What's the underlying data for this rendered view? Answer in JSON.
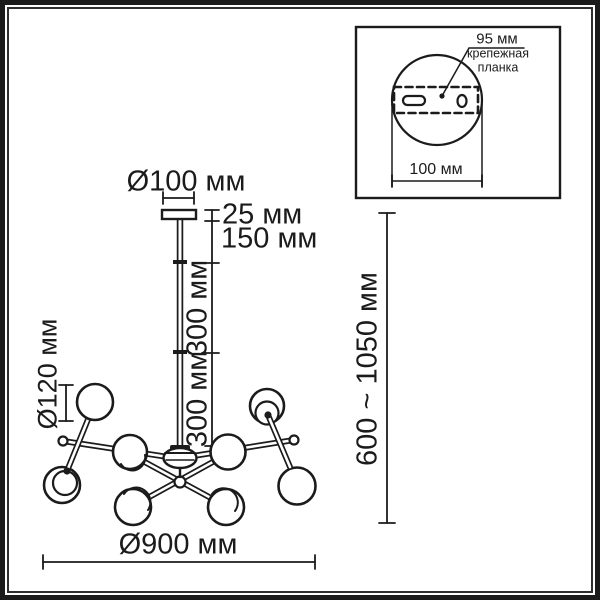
{
  "drawing": {
    "type": "chandelier dimension diagram",
    "units": "мм",
    "line_color": "#1b1b1b",
    "background": "#ffffff"
  },
  "main": {
    "labels": {
      "canopy_diameter": "Ø100 мм",
      "canopy_thickness": "25 мм",
      "stem_top_section": "150 мм",
      "stem_section_upper": "300 мм",
      "stem_section_lower": "300 мм",
      "globe_diameter": "Ø120 мм",
      "fixture_diameter": "Ø900 мм",
      "overall_height": "600 ~ 1050 мм"
    }
  },
  "inset": {
    "labels": {
      "plate_width": "95 мм",
      "plate_name": "крепежная\nпланка",
      "base_width": "100 мм"
    }
  }
}
